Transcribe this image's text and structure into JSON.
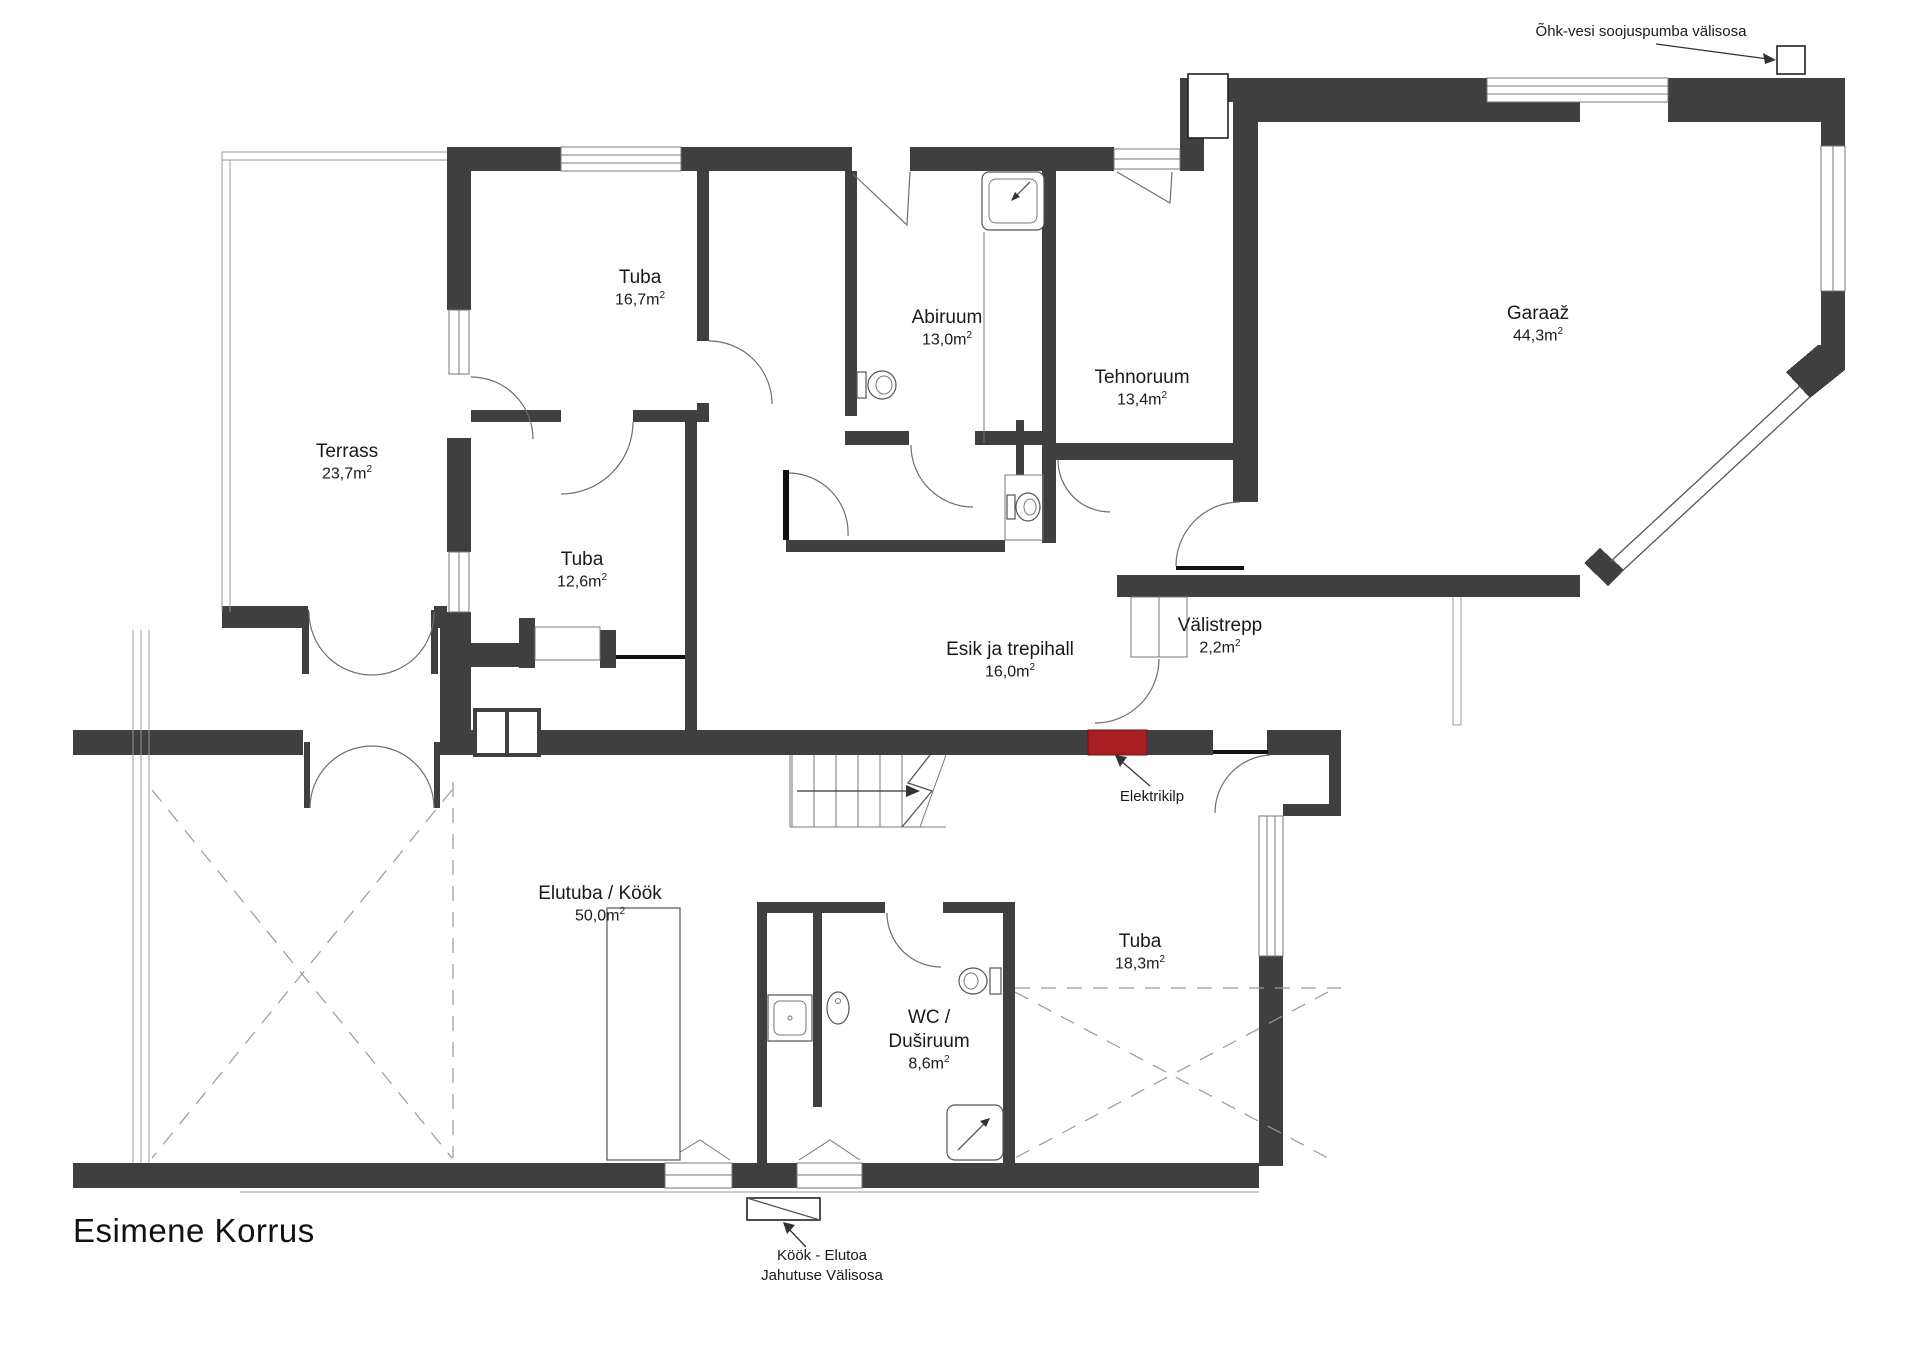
{
  "title": "Esimene Korrus",
  "rooms": [
    {
      "name": "Tuba",
      "area": "16,7m",
      "sup": "2"
    },
    {
      "name": "Terrass",
      "area": "23,7m",
      "sup": "2"
    },
    {
      "name": "Tuba",
      "area": "12,6m",
      "sup": "2"
    },
    {
      "name": "Abiruum",
      "area": "13,0m",
      "sup": "2"
    },
    {
      "name": "Tehnoruum",
      "area": "13,4m",
      "sup": "2"
    },
    {
      "name": "Garaaž",
      "area": "44,3m",
      "sup": "2"
    },
    {
      "name": "Välistrepp",
      "area": "2,2m",
      "sup": "2"
    },
    {
      "name": "Esik ja trepihall",
      "area": "16,0m",
      "sup": "2"
    },
    {
      "name": "Elutuba / Köök",
      "area": "50,0m",
      "sup": "2"
    },
    {
      "name": "Tuba",
      "area": "18,3m",
      "sup": "2"
    },
    {
      "name": "WC /",
      "name2": "Duširuum",
      "area": "8,6m",
      "sup": "2"
    }
  ],
  "annotations": {
    "heat_pump": "Õhk-vesi soojuspumba välisosa",
    "electrical_panel": "Elektrikilp",
    "cooling_line1": "Köök - Elutoa",
    "cooling_line2": "Jahutuse Välisosa"
  },
  "colors": {
    "wall": "#3f3f3f",
    "electrical_panel_red": "#a81e23",
    "line": "#6e6e6e",
    "dashed": "#9a9a9a",
    "text": "#1a1a1a"
  }
}
